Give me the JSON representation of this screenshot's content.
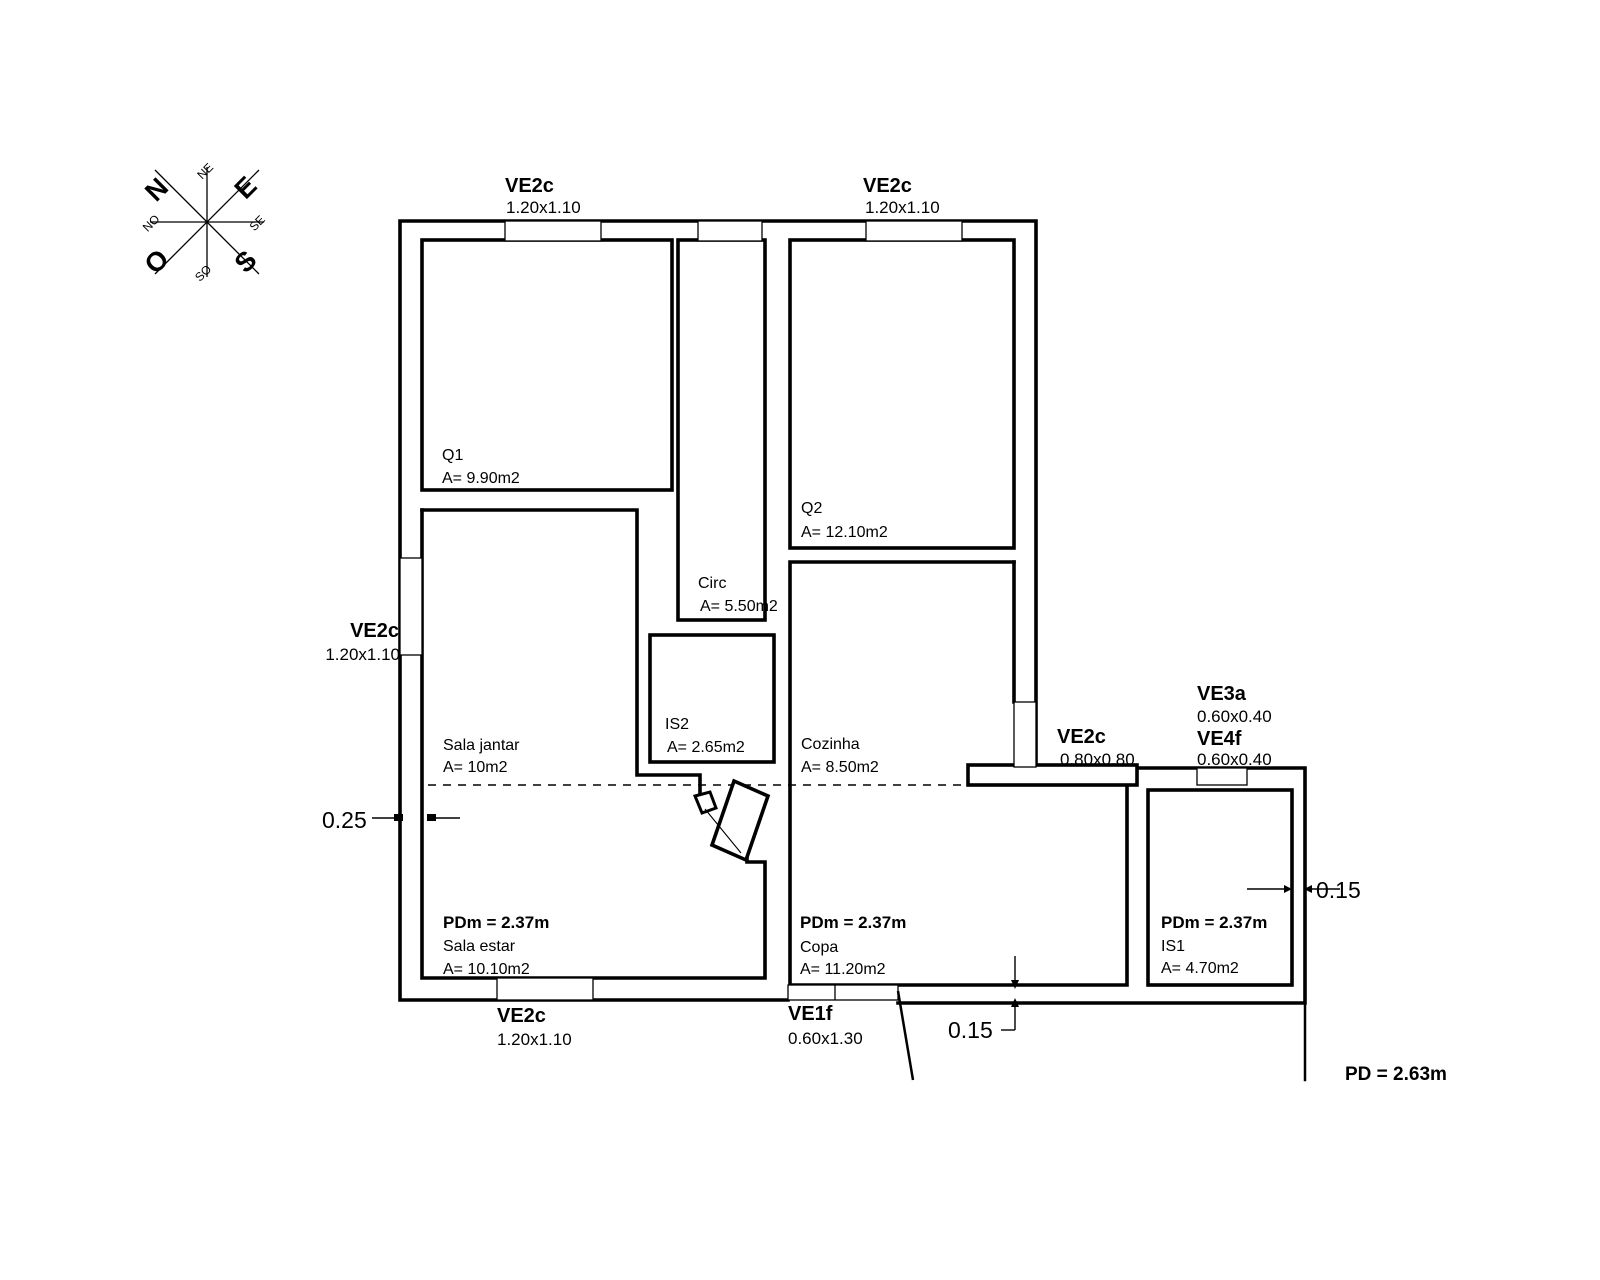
{
  "compass": {
    "n": "N",
    "e": "E",
    "s": "S",
    "o": "O",
    "ne": "NE",
    "se": "SE",
    "so": "SO",
    "no": "NO"
  },
  "windows": {
    "top_left": {
      "name": "VE2c",
      "size": "1.20x1.10"
    },
    "top_right": {
      "name": "VE2c",
      "size": "1.20x1.10"
    },
    "left": {
      "name": "VE2c",
      "size": "1.20x1.10"
    },
    "bottom": {
      "name": "VE2c",
      "size": "1.20x1.10"
    },
    "entry": {
      "name": "VE1f",
      "size": "0.60x1.30"
    },
    "kitchen": {
      "name": "VE2c",
      "size": "0.80x0.80"
    },
    "ve3a": {
      "name": "VE3a",
      "size": "0.60x0.40"
    },
    "ve4f": {
      "name": "VE4f",
      "size": "0.60x0.40"
    }
  },
  "rooms": {
    "q1": {
      "name": "Q1",
      "area": "A= 9.90m2"
    },
    "q2": {
      "name": "Q2",
      "area": "A= 12.10m2"
    },
    "circ": {
      "name": "Circ",
      "area": "A= 5.50m2"
    },
    "is2": {
      "name": "IS2",
      "area": "A= 2.65m2"
    },
    "sala_jantar": {
      "name": "Sala jantar",
      "area": "A= 10m2"
    },
    "cozinha": {
      "name": "Cozinha",
      "area": "A= 8.50m2"
    },
    "sala_estar": {
      "name": "Sala estar",
      "area": "A= 10.10m2",
      "pdm": "PDm = 2.37m"
    },
    "copa": {
      "name": "Copa",
      "area": "A= 11.20m2",
      "pdm": "PDm = 2.37m"
    },
    "is1": {
      "name": "IS1",
      "area": "A= 4.70m2",
      "pdm": "PDm = 2.37m"
    }
  },
  "dimensions": {
    "wall_left": "0.25",
    "wall_bottom": "0.15",
    "wall_right": "0.15",
    "ceiling": "PD = 2.63m"
  },
  "colors": {
    "dimension": "#a83232",
    "line": "#000000"
  }
}
